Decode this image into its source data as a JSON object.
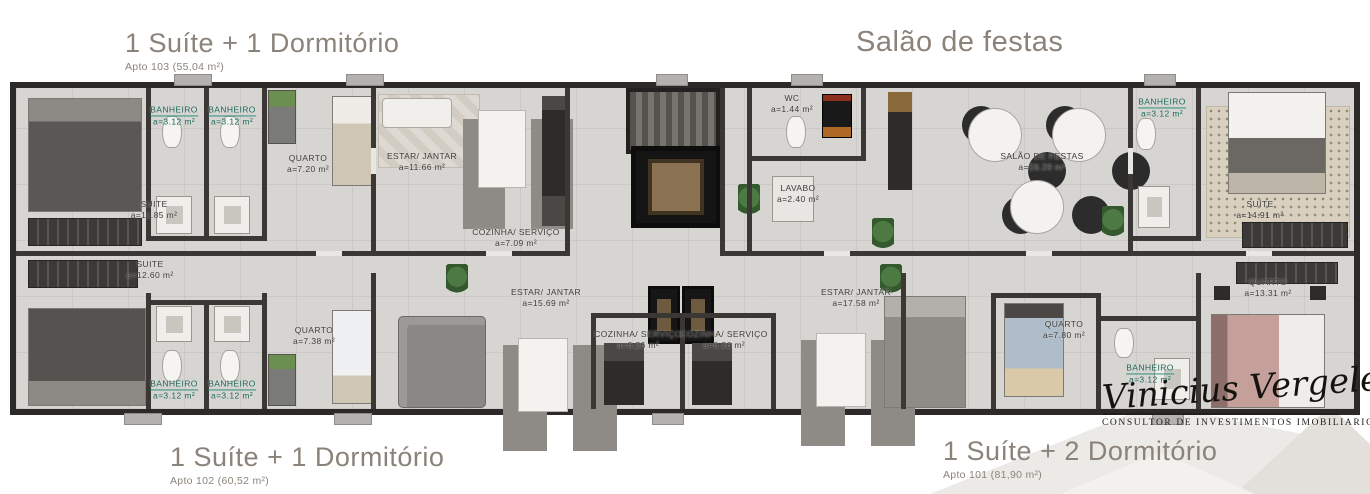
{
  "titles": [
    {
      "id": "apto103",
      "title": "1 Suíte + 1 Dormitório",
      "subtitle": "Apto 103 (55,04 m²)"
    },
    {
      "id": "salao-de-festas",
      "title": "Salão de festas",
      "subtitle": ""
    },
    {
      "id": "apto102",
      "title": "1 Suíte + 1 Dormitório",
      "subtitle": "Apto 102 (60,52 m²)"
    },
    {
      "id": "apto101",
      "title": "1 Suíte + 2 Dormitório",
      "subtitle": "Apto 101 (81,90 m²)"
    }
  ],
  "rooms": [
    {
      "name": "SUITE",
      "area": "a=11.85 m²",
      "x": 138,
      "y": 122,
      "accent": false
    },
    {
      "name": "BANHEIRO",
      "area": "a=3.12 m²",
      "x": 158,
      "y": 28,
      "accent": true
    },
    {
      "name": "BANHEIRO",
      "area": "a=3.12 m²",
      "x": 216,
      "y": 28,
      "accent": true
    },
    {
      "name": "QUARTO",
      "area": "a=7.20 m²",
      "x": 292,
      "y": 76,
      "accent": false
    },
    {
      "name": "ESTAR/ JANTAR",
      "area": "a=11.66 m²",
      "x": 406,
      "y": 74,
      "accent": false
    },
    {
      "name": "COZINHA/ SERVIÇO",
      "area": "a=7.09 m²",
      "x": 500,
      "y": 150,
      "accent": false
    },
    {
      "name": "WC",
      "area": "a=1.44 m²",
      "x": 776,
      "y": 16,
      "accent": false
    },
    {
      "name": "LAVABO",
      "area": "a=2.40 m²",
      "x": 782,
      "y": 106,
      "accent": false
    },
    {
      "name": "SALÃO DE FESTAS",
      "area": "a=28.29 m²",
      "x": 1026,
      "y": 74,
      "accent": false
    },
    {
      "name": "BANHEIRO",
      "area": "a=3.12 m²",
      "x": 1146,
      "y": 20,
      "accent": true
    },
    {
      "name": "SUÍTE",
      "area": "a=14.91 m²",
      "x": 1244,
      "y": 122,
      "accent": false
    },
    {
      "name": "SUITE",
      "area": "a=12.60 m²",
      "x": 134,
      "y": 182,
      "accent": false
    },
    {
      "name": "BANHEIRO",
      "area": "a=3.12 m²",
      "x": 158,
      "y": 302,
      "accent": true
    },
    {
      "name": "BANHEIRO",
      "area": "a=3.12 m²",
      "x": 216,
      "y": 302,
      "accent": true
    },
    {
      "name": "QUARTO",
      "area": "a=7.38 m²",
      "x": 298,
      "y": 248,
      "accent": false
    },
    {
      "name": "ESTAR/ JANTAR",
      "area": "a=15.69 m²",
      "x": 530,
      "y": 210,
      "accent": false
    },
    {
      "name": "COZINHA/ SERVIÇO",
      "area": "a=6.26 m²",
      "x": 622,
      "y": 252,
      "accent": false
    },
    {
      "name": "COZINHA/ SERVIÇO",
      "area": "a=6.26 m²",
      "x": 708,
      "y": 252,
      "accent": false
    },
    {
      "name": "ESTAR/ JANTAR",
      "area": "a=17.58 m²",
      "x": 840,
      "y": 210,
      "accent": false
    },
    {
      "name": "QUARTO",
      "area": "a=7.80 m²",
      "x": 1048,
      "y": 242,
      "accent": false
    },
    {
      "name": "QUARTO",
      "area": "a=13.31 m²",
      "x": 1252,
      "y": 200,
      "accent": false
    },
    {
      "name": "BANHEIRO",
      "area": "a=3.12 m²",
      "x": 1134,
      "y": 286,
      "accent": true
    }
  ],
  "watermark": {
    "signature": "Vinicius Vergeletti",
    "tagline": "CONSULTOR DE INVESTIMENTOS IMOBILIARIOS"
  },
  "colors": {
    "title_text": "#8b8379",
    "label_text": "#3f3e3c",
    "bathroom_label": "#1b685a",
    "wall": "#2c2a28",
    "floor": "#d7d5d2",
    "elevator_floor": "#8a7252",
    "watermark_shape": "#eceae7"
  }
}
